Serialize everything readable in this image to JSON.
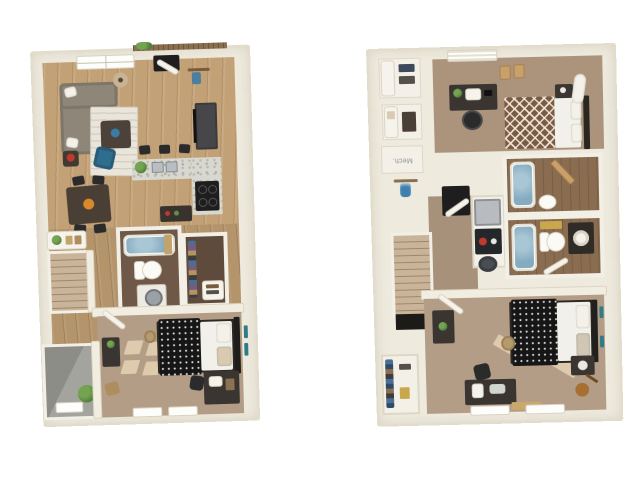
{
  "image": {
    "type": "two-story apartment 3D floor plan rendering",
    "background": "#ffffff"
  },
  "labels": {
    "mech_room": "Mech."
  },
  "palette": {
    "wall_cream": "#eeeade",
    "wood_floor": "#c3a176",
    "bedroom_carpet": "#b49d86",
    "bath_floor_dark": "#6f5847",
    "bath_floor_wood": "#8a6d51",
    "patio_concrete": "#9a9a95",
    "tub_water_blue": "#84abc0",
    "granite_counter": "#d8d8d0",
    "dark_furniture": "#3a3531",
    "appliance_black": "#1e1e1e",
    "sofa_gray": "#8e8678",
    "accent_chair_blue": "#2f6d8e",
    "duvet_black": "#161616",
    "duvet_brown_pattern": "#7a5a42",
    "plant_green": "#4e7d3a",
    "bath_mat_gold": "#c9a84c",
    "stair_tan": "#c3ae92"
  }
}
